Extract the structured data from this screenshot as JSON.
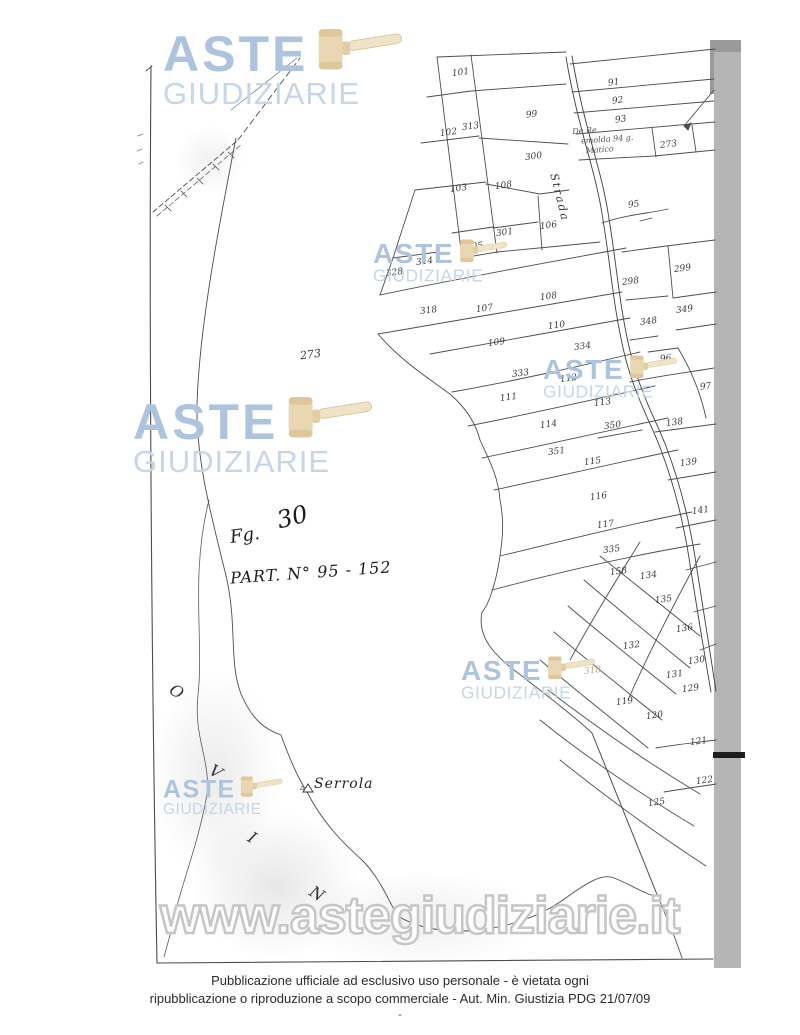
{
  "watermark": {
    "brand_line1": "ASTE",
    "brand_line2": "GIUDIZIARIE",
    "url": "www.astegiudiziarie.it",
    "colors": {
      "brand_blue": "#aec4de",
      "brand_blue_light": "#c7d5e9",
      "gavel_tan": "#e9d6b2",
      "gavel_tan_dark": "#dec79a",
      "url_outline": "#c6c6c6"
    },
    "instances": [
      {
        "x": 163,
        "y": 30,
        "s": 1
      },
      {
        "x": 133,
        "y": 398,
        "s": 1
      },
      {
        "x": 373,
        "y": 240,
        "s": 0.56
      },
      {
        "x": 543,
        "y": 356,
        "s": 0.56
      },
      {
        "x": 461,
        "y": 657,
        "s": 0.56
      },
      {
        "x": 163,
        "y": 777,
        "s": 0.5
      }
    ]
  },
  "map": {
    "handwritten": {
      "sheet_label": "Fg.",
      "sheet_number": "30",
      "parcel_note": "PART. N° 95 - 152",
      "pencil_note_lines": [
        "De Re",
        "emolda 94 g.",
        "Matico"
      ]
    },
    "labels": {
      "road": "Strada",
      "locality": "Serrola",
      "trig_point": "▵",
      "boundary_letters": [
        "O",
        "V",
        "I",
        "N"
      ]
    },
    "boundary_letter_pos": [
      {
        "x": 170,
        "y": 682
      },
      {
        "x": 210,
        "y": 762
      },
      {
        "x": 249,
        "y": 828
      },
      {
        "x": 310,
        "y": 884
      }
    ],
    "parcels": [
      {
        "n": "101",
        "x": 452,
        "y": 68
      },
      {
        "n": "313",
        "x": 462,
        "y": 122
      },
      {
        "n": "99",
        "x": 526,
        "y": 110
      },
      {
        "n": "102",
        "x": 440,
        "y": 128
      },
      {
        "n": "300",
        "x": 525,
        "y": 152
      },
      {
        "n": "103",
        "x": 450,
        "y": 184
      },
      {
        "n": "108",
        "x": 495,
        "y": 181
      },
      {
        "n": "91",
        "x": 608,
        "y": 78
      },
      {
        "n": "92",
        "x": 612,
        "y": 96
      },
      {
        "n": "93",
        "x": 615,
        "y": 115
      },
      {
        "n": "273",
        "x": 660,
        "y": 140
      },
      {
        "n": "95",
        "x": 628,
        "y": 200
      },
      {
        "n": "106",
        "x": 540,
        "y": 221
      },
      {
        "n": "301",
        "x": 496,
        "y": 228
      },
      {
        "n": "105",
        "x": 466,
        "y": 242
      },
      {
        "n": "328",
        "x": 386,
        "y": 268
      },
      {
        "n": "314",
        "x": 416,
        "y": 257
      },
      {
        "n": "318",
        "x": 420,
        "y": 306
      },
      {
        "n": "107",
        "x": 476,
        "y": 304
      },
      {
        "n": "108",
        "x": 540,
        "y": 292
      },
      {
        "n": "110",
        "x": 548,
        "y": 321
      },
      {
        "n": "109",
        "x": 488,
        "y": 338
      },
      {
        "n": "334",
        "x": 574,
        "y": 342
      },
      {
        "n": "333",
        "x": 512,
        "y": 369
      },
      {
        "n": "111",
        "x": 500,
        "y": 393
      },
      {
        "n": "112",
        "x": 560,
        "y": 374
      },
      {
        "n": "113",
        "x": 594,
        "y": 398
      },
      {
        "n": "298",
        "x": 622,
        "y": 277
      },
      {
        "n": "299",
        "x": 674,
        "y": 264
      },
      {
        "n": "349",
        "x": 676,
        "y": 305
      },
      {
        "n": "348",
        "x": 640,
        "y": 317
      },
      {
        "n": "96",
        "x": 660,
        "y": 354
      },
      {
        "n": "97",
        "x": 700,
        "y": 382
      },
      {
        "n": "273",
        "x": 300,
        "y": 348,
        "big": true
      },
      {
        "n": "114",
        "x": 540,
        "y": 420
      },
      {
        "n": "350",
        "x": 604,
        "y": 421
      },
      {
        "n": "138",
        "x": 666,
        "y": 418
      },
      {
        "n": "351",
        "x": 548,
        "y": 447
      },
      {
        "n": "115",
        "x": 584,
        "y": 457
      },
      {
        "n": "139",
        "x": 680,
        "y": 458
      },
      {
        "n": "116",
        "x": 590,
        "y": 492
      },
      {
        "n": "141",
        "x": 692,
        "y": 506
      },
      {
        "n": "117",
        "x": 597,
        "y": 520
      },
      {
        "n": "335",
        "x": 603,
        "y": 545
      },
      {
        "n": "158",
        "x": 610,
        "y": 567
      },
      {
        "n": "134",
        "x": 640,
        "y": 571
      },
      {
        "n": "135",
        "x": 655,
        "y": 595
      },
      {
        "n": "136",
        "x": 676,
        "y": 624
      },
      {
        "n": "132",
        "x": 623,
        "y": 641
      },
      {
        "n": "130",
        "x": 688,
        "y": 656
      },
      {
        "n": "131",
        "x": 666,
        "y": 670
      },
      {
        "n": "129",
        "x": 682,
        "y": 684
      },
      {
        "n": "119",
        "x": 616,
        "y": 697
      },
      {
        "n": "120",
        "x": 646,
        "y": 711
      },
      {
        "n": "318",
        "x": 584,
        "y": 666,
        "faint": true
      },
      {
        "n": "121",
        "x": 690,
        "y": 737
      },
      {
        "n": "122",
        "x": 696,
        "y": 776
      },
      {
        "n": "125",
        "x": 648,
        "y": 798
      }
    ]
  },
  "footer": {
    "line1": "Pubblicazione ufficiale ad esclusivo uso personale - è vietata ogni",
    "line2": "ripubblicazione o riproduzione a scopo commerciale - Aut. Min. Giustizia PDG 21/07/09",
    "dash": "-"
  }
}
